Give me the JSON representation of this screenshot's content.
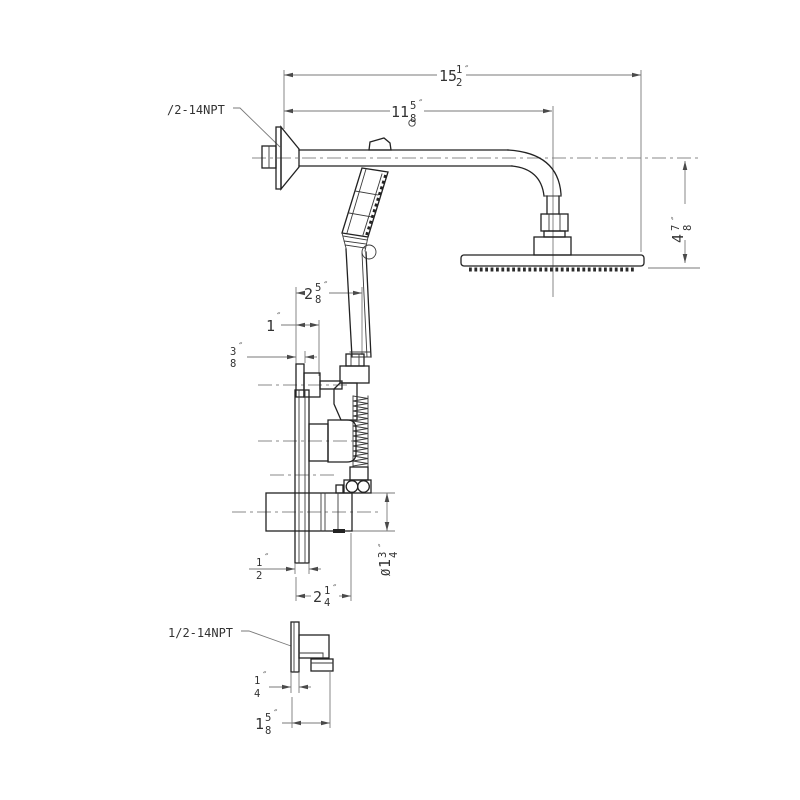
{
  "drawing": {
    "kind": "technical-drawing",
    "product": "Wall-mounted shower system: rain shower head, docked handheld wand, mixer valve and wall supply elbow",
    "units": "inches",
    "colors": {
      "background": "#ffffff",
      "object_line": "#222222",
      "dim_line": "#7a7a7a",
      "text": "#333333"
    },
    "connection_labels": {
      "arm_thread": "/2-14NPT",
      "elbow_thread": "1/2-14NPT"
    },
    "dimensions": {
      "overall_width": {
        "whole": "15",
        "num": "1",
        "den": "2",
        "unit": "″"
      },
      "arm_length": {
        "whole": "11",
        "num": "5",
        "den": "8",
        "unit": "″"
      },
      "head_drop": {
        "whole": "4",
        "num": "7",
        "den": "8",
        "unit": "″"
      },
      "wand_offset": {
        "whole": "2",
        "num": "5",
        "den": "8",
        "unit": "″"
      },
      "knob_projection": {
        "whole": "1",
        "num": "",
        "den": "",
        "unit": "″"
      },
      "knob_plate": {
        "whole": "",
        "num": "3",
        "den": "8",
        "unit": "″"
      },
      "plate_thickness": {
        "whole": "",
        "num": "1",
        "den": "2",
        "unit": "″"
      },
      "valve_projection": {
        "whole": "2",
        "num": "1",
        "den": "4",
        "unit": "″"
      },
      "valve_bore": {
        "prefix": "Ø",
        "whole": "1",
        "num": "3",
        "den": "4",
        "unit": "″"
      },
      "elbow_plate": {
        "whole": "",
        "num": "1",
        "den": "4",
        "unit": "″"
      },
      "elbow_projection": {
        "whole": "1",
        "num": "5",
        "den": "8",
        "unit": "″"
      }
    }
  }
}
